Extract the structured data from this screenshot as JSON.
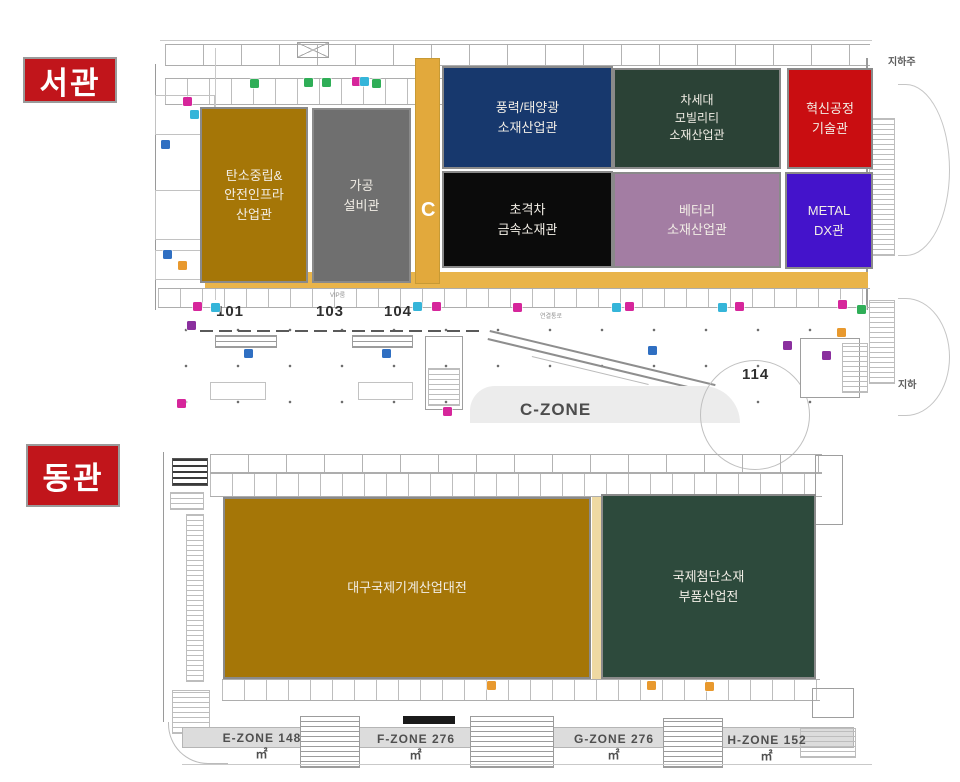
{
  "west": {
    "badge": "서관",
    "blocks": [
      {
        "name": "carbon-neutral-safety-infra-hall",
        "label": "탄소중립&\n안전인프라\n산업관",
        "color": "#a57607"
      },
      {
        "name": "processing-equipment-hall",
        "label": "가공\n설비관",
        "color": "#6f6f6f"
      },
      {
        "name": "wind-solar-materials-hall",
        "label": "풍력/태양광\n소재산업관",
        "color": "#17386d"
      },
      {
        "name": "next-gen-mobility-materials-hall",
        "label": "차세대\n모빌리티\n소재산업관",
        "color": "#2b4236"
      },
      {
        "name": "innovation-process-tech-hall",
        "label": "혁신공정\n기술관",
        "color": "#c90d11"
      },
      {
        "name": "ultra-metal-materials-hall",
        "label": "초격차\n금속소재관",
        "color": "#0b0b0b"
      },
      {
        "name": "battery-materials-hall",
        "label": "베터리\n소재산업관",
        "color": "#a37da3"
      },
      {
        "name": "metal-dx-hall",
        "label": "METAL\nDX관",
        "color": "#4413cb"
      }
    ],
    "corridor_letter": "C",
    "room_numbers": {
      "r101": "101",
      "r103": "103",
      "r104": "104",
      "r114": "114"
    },
    "zone_label": "C-ZONE",
    "corridor_text": "연결통로",
    "vip_text": "VIP룸",
    "exterior_labels": {
      "top_right": "지하주",
      "bottom_right": "지하"
    }
  },
  "east": {
    "badge": "동관",
    "blocks": [
      {
        "name": "daegu-machinery-expo",
        "label": "대구국제기계산업대전",
        "color": "#a57607"
      },
      {
        "name": "advanced-materials-parts-expo",
        "label": "국제첨단소재\n부품산업전",
        "color": "#2d4a3c"
      }
    ],
    "zones": [
      {
        "label": "E-ZONE 148㎡"
      },
      {
        "label": "F-ZONE 276㎡"
      },
      {
        "label": "G-ZONE 276㎡"
      },
      {
        "label": "H-ZONE 152㎡"
      }
    ]
  },
  "palette": {
    "badge_red": "#c1151b",
    "corridor_yellow": "#e2a93c",
    "band_yellow": "#e9b44a",
    "strip_yellow": "#eed9a2",
    "zone_band_gray": "#dcdcdc",
    "marker_magenta": "#d6269b",
    "marker_cyan": "#35b5d9",
    "marker_green": "#2fae57",
    "marker_blue": "#2f6fc2",
    "marker_purple": "#8a2f9e",
    "marker_orange": "#e8992e"
  },
  "markers": [
    {
      "x": 183,
      "y": 97,
      "c": "m"
    },
    {
      "x": 352,
      "y": 77,
      "c": "m"
    },
    {
      "x": 360,
      "y": 77,
      "c": "c"
    },
    {
      "x": 190,
      "y": 110,
      "c": "c"
    },
    {
      "x": 250,
      "y": 79,
      "c": "g"
    },
    {
      "x": 304,
      "y": 78,
      "c": "g"
    },
    {
      "x": 322,
      "y": 78,
      "c": "g"
    },
    {
      "x": 372,
      "y": 79,
      "c": "g"
    },
    {
      "x": 161,
      "y": 140,
      "c": "b"
    },
    {
      "x": 163,
      "y": 250,
      "c": "b"
    },
    {
      "x": 178,
      "y": 261,
      "c": "o"
    },
    {
      "x": 193,
      "y": 302,
      "c": "m"
    },
    {
      "x": 211,
      "y": 303,
      "c": "c"
    },
    {
      "x": 413,
      "y": 302,
      "c": "c"
    },
    {
      "x": 432,
      "y": 302,
      "c": "m"
    },
    {
      "x": 513,
      "y": 303,
      "c": "m"
    },
    {
      "x": 612,
      "y": 303,
      "c": "c"
    },
    {
      "x": 625,
      "y": 302,
      "c": "m"
    },
    {
      "x": 718,
      "y": 303,
      "c": "c"
    },
    {
      "x": 735,
      "y": 302,
      "c": "m"
    },
    {
      "x": 838,
      "y": 300,
      "c": "m"
    },
    {
      "x": 857,
      "y": 305,
      "c": "g"
    },
    {
      "x": 187,
      "y": 321,
      "c": "p"
    },
    {
      "x": 244,
      "y": 349,
      "c": "b"
    },
    {
      "x": 382,
      "y": 349,
      "c": "b"
    },
    {
      "x": 648,
      "y": 346,
      "c": "b"
    },
    {
      "x": 783,
      "y": 341,
      "c": "p"
    },
    {
      "x": 822,
      "y": 351,
      "c": "p"
    },
    {
      "x": 837,
      "y": 328,
      "c": "o"
    },
    {
      "x": 177,
      "y": 399,
      "c": "m"
    },
    {
      "x": 443,
      "y": 407,
      "c": "m"
    },
    {
      "x": 487,
      "y": 681,
      "c": "o"
    },
    {
      "x": 647,
      "y": 681,
      "c": "o"
    },
    {
      "x": 705,
      "y": 682,
      "c": "o"
    }
  ]
}
